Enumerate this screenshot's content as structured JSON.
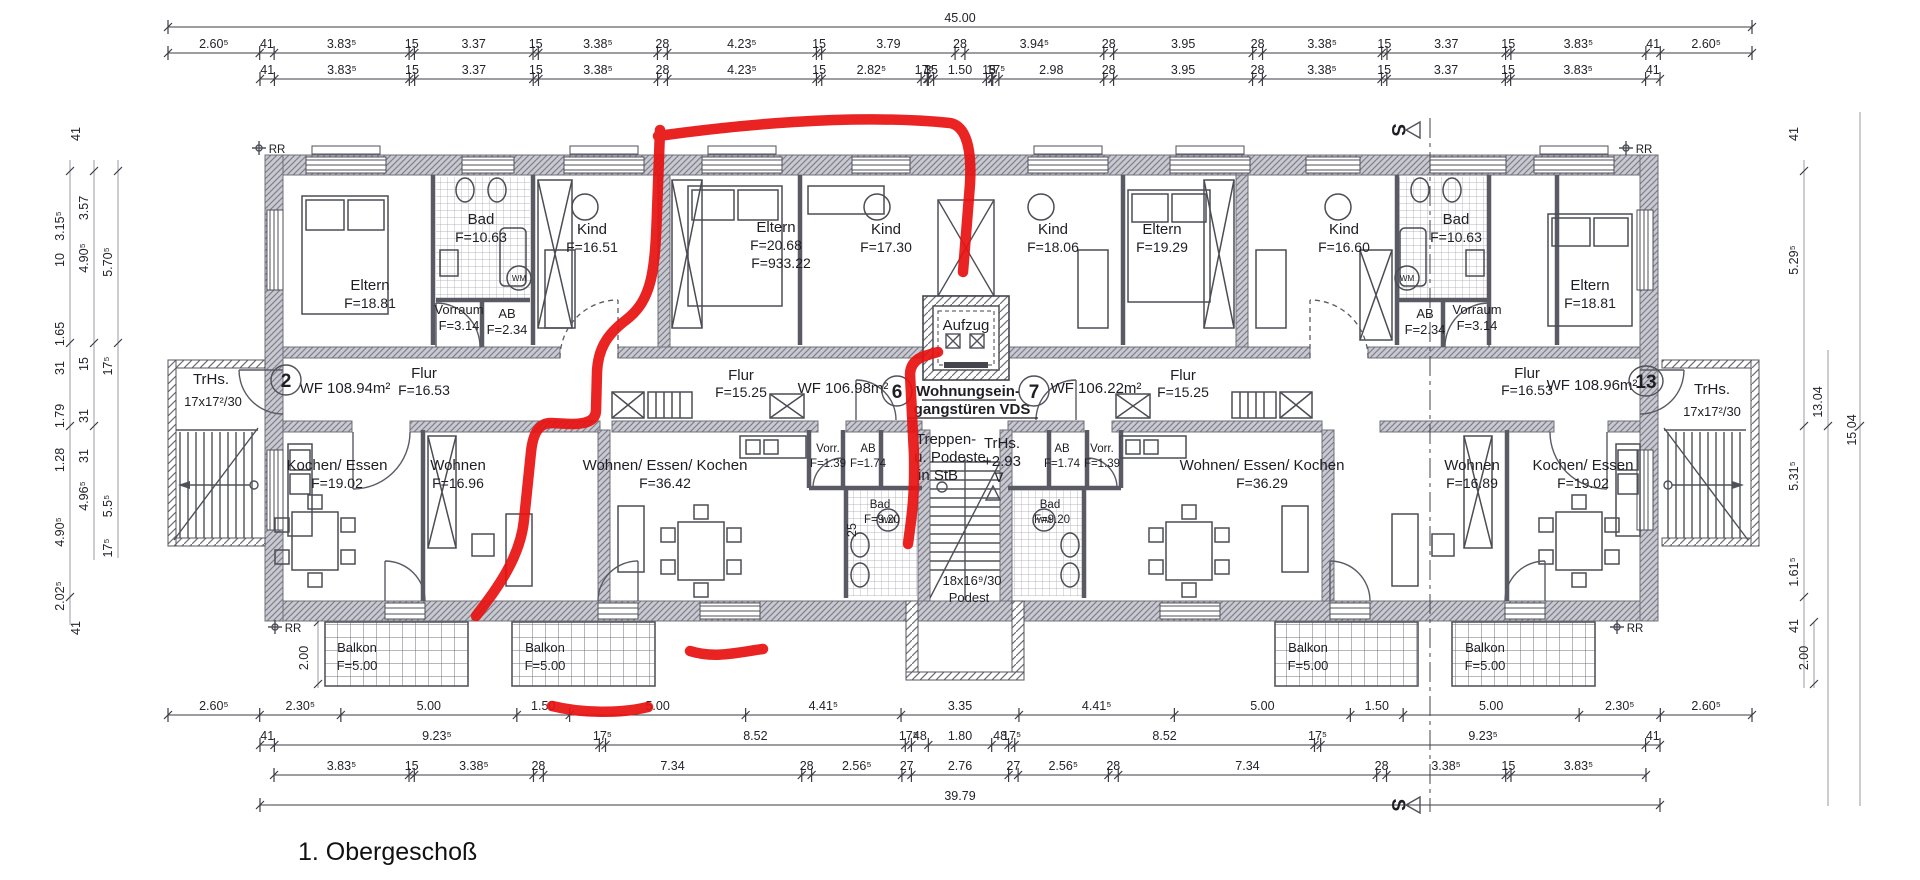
{
  "title": "1. Obergeschoß",
  "colors": {
    "marker_red": "#e81010",
    "wall_gray": "#c9c9d1",
    "line_dark": "#45454e"
  },
  "plan": {
    "aufzug": "Aufzug",
    "wohnungseingang_line1": "Wohnungsein-",
    "wohnungseingang_line2": "gangstüren VDS",
    "treppen_line1": "Treppen-",
    "treppen_line2": "u. Podeste",
    "treppen_line3": "in StB",
    "trhs_center_line1": "TrHs.",
    "trhs_center_line2": "+2.93",
    "nabla": "∇",
    "podest_line1": "18x16⁹/30",
    "podest_line2": "Podest",
    "trhs_left_line1": "TrHs.",
    "trhs_left_line2": "17x17²/30",
    "trhs_right_line1": "TrHs.",
    "trhs_right_line2": "17x17²/30",
    "wm": "WM",
    "rr_marker": "RR",
    "section_marker": "S",
    "units": {
      "left": "2",
      "center_left": "6",
      "center_right": "7",
      "right": "13"
    }
  },
  "rooms": [
    {
      "name": "Eltern",
      "area": "F=18.81"
    },
    {
      "name": "Bad",
      "area": "F=10.63"
    },
    {
      "name": "Kind",
      "area": "F=16.51"
    },
    {
      "name": "Eltern",
      "area": "F=20.68",
      "area2": "F=933.22"
    },
    {
      "name": "Kind",
      "area": "F=17.30"
    },
    {
      "name": "Kind",
      "area": "F=18.06"
    },
    {
      "name": "Eltern",
      "area": "F=19.29"
    },
    {
      "name": "Kind",
      "area": "F=16.60"
    },
    {
      "name": "Bad",
      "area": "F=10.63"
    },
    {
      "name": "Eltern",
      "area": "F=18.81"
    },
    {
      "name": "Vorraum",
      "area": "F=3.14"
    },
    {
      "name": "AB",
      "area": "F=2.34"
    },
    {
      "name": "AB",
      "area": "F=2.34"
    },
    {
      "name": "Vorraum",
      "area": "F=3.14"
    },
    {
      "name": "Kochen/ Essen",
      "area": "F=19.02"
    },
    {
      "name": "Wohnen",
      "area": "F=16.96"
    },
    {
      "name": "Wohnen/ Essen/ Kochen",
      "area": "F=36.42"
    },
    {
      "name": "Vorr.",
      "area": "F=1.39"
    },
    {
      "name": "AB",
      "area": "F=1.74"
    },
    {
      "name": "Bad",
      "area": "F=9.20"
    },
    {
      "name": "AB",
      "area": "F=1.74"
    },
    {
      "name": "Vorr.",
      "area": "F=1.39"
    },
    {
      "name": "Bad",
      "area": "F=9.20"
    },
    {
      "name": "Wohnen/ Essen/ Kochen",
      "area": "F=36.29"
    },
    {
      "name": "Wohnen",
      "area": "F=16.89"
    },
    {
      "name": "Kochen/ Essen",
      "area": "F=19.02"
    }
  ],
  "corridor": [
    {
      "line1": "Flur",
      "line2": "F=16.53"
    },
    {
      "line1": "WF 108.94m²"
    },
    {
      "line1": "Flur",
      "line2": "F=15.25"
    },
    {
      "line1": "WF 106.98m²"
    },
    {
      "line1": "WF 106.22m²"
    },
    {
      "line1": "Flur",
      "line2": "F=15.25"
    },
    {
      "line1": "Flur",
      "line2": "F=16.53"
    },
    {
      "line1": "WF 108.96m²"
    }
  ],
  "balconies": [
    {
      "name": "Balkon",
      "area": "F=5.00"
    },
    {
      "name": "Balkon",
      "area": "F=5.00"
    },
    {
      "name": "Balkon",
      "area": "F=5.00"
    },
    {
      "name": "Balkon",
      "area": "F=5.00"
    }
  ],
  "dims": {
    "top_total": [
      "45.00"
    ],
    "top_row_a": [
      "2.60⁵",
      "41",
      "3.83⁵",
      "15",
      "3.37",
      "15",
      "3.38⁵",
      "28",
      "4.23⁵",
      "15",
      "3.79",
      "28",
      "3.94⁵",
      "28",
      "3.95",
      "28",
      "3.38⁵",
      "15",
      "3.37",
      "15",
      "3.83⁵",
      "41",
      "2.60⁵"
    ],
    "top_row_b": [
      "41",
      "3.83⁵",
      "15",
      "3.37",
      "15",
      "3.38⁵",
      "28",
      "4.23⁵",
      "15",
      "2.82⁵",
      "17⁵",
      "3",
      "15",
      "1.50",
      "15",
      "3",
      "17⁵",
      "2.98",
      "28",
      "3.95",
      "28",
      "3.38⁵",
      "15",
      "3.37",
      "15",
      "3.83⁵",
      "41"
    ],
    "bottom_row_a": [
      "2.60⁵",
      "2.30⁵",
      "5.00",
      "1.50",
      "5.00",
      "4.41⁵",
      "3.35",
      "4.41⁵",
      "5.00",
      "1.50",
      "5.00",
      "2.30⁵",
      "2.60⁵"
    ],
    "bottom_row_b": [
      "41",
      "9.23⁵",
      "17⁵",
      "8.52",
      "17⁵",
      "48",
      "1.80",
      "48",
      "17⁵",
      "8.52",
      "17⁵",
      "9.23⁵",
      "41"
    ],
    "bottom_row_c": [
      "3.83⁵",
      "15",
      "3.38⁵",
      "28",
      "7.34",
      "28",
      "2.56⁵",
      "27",
      "2.76",
      "27",
      "2.56⁵",
      "28",
      "7.34",
      "28",
      "3.38⁵",
      "15",
      "3.83⁵"
    ],
    "bottom_total": [
      "39.79"
    ],
    "left_stack": [
      "41",
      "3.15⁵",
      "3.57",
      "4.90⁵",
      "5.70⁵",
      "10",
      "1.65",
      "31",
      "15",
      "17⁵",
      "1.79",
      "31",
      "1.28",
      "31",
      "4.96⁵",
      "4.90⁵",
      "5.5⁵",
      "17⁵",
      "2.02⁵",
      "41",
      "2.00"
    ],
    "right_stack": [
      "41",
      "5.29⁵",
      "13.04",
      "15.04",
      "5.31⁵",
      "1.61⁵",
      "41",
      "2.00"
    ],
    "stair_wall": "25"
  }
}
